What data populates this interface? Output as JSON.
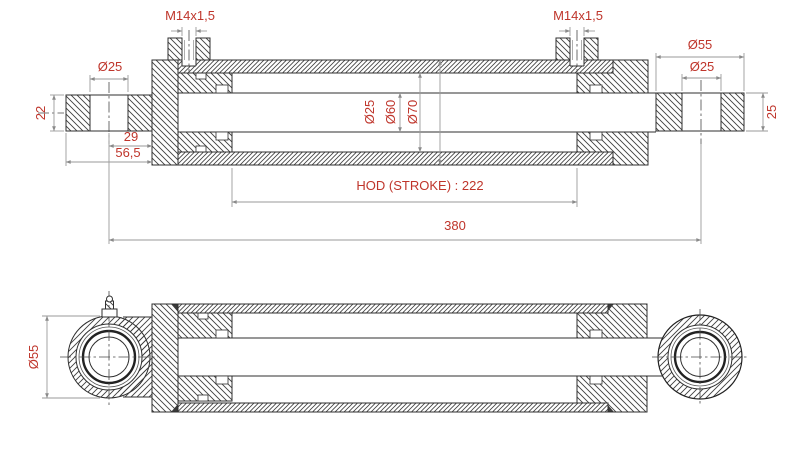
{
  "drawing": {
    "description": "Hydraulic steering cylinder technical drawing, two section views",
    "accent_color": "#bf352b",
    "line_color": "#2f2f2f",
    "dim_line_color": "#9a9a9a"
  },
  "top_view": {
    "port_left": "M14x1,5",
    "port_right": "M14x1,5",
    "left_eye_bore": "Ø25",
    "left_eye_width": "22",
    "pin_to_face": "29",
    "eye_to_face": "56,5",
    "rod_dia": "Ø25",
    "bore_dia": "Ø60",
    "barrel_od": "Ø70",
    "right_eye_od": "Ø55",
    "right_eye_bore": "Ø25",
    "right_eye_width": "25",
    "stroke_dim": "HOD (STROKE) : 222",
    "overall_length": "380"
  },
  "bottom_view": {
    "eye_od": "Ø55"
  }
}
